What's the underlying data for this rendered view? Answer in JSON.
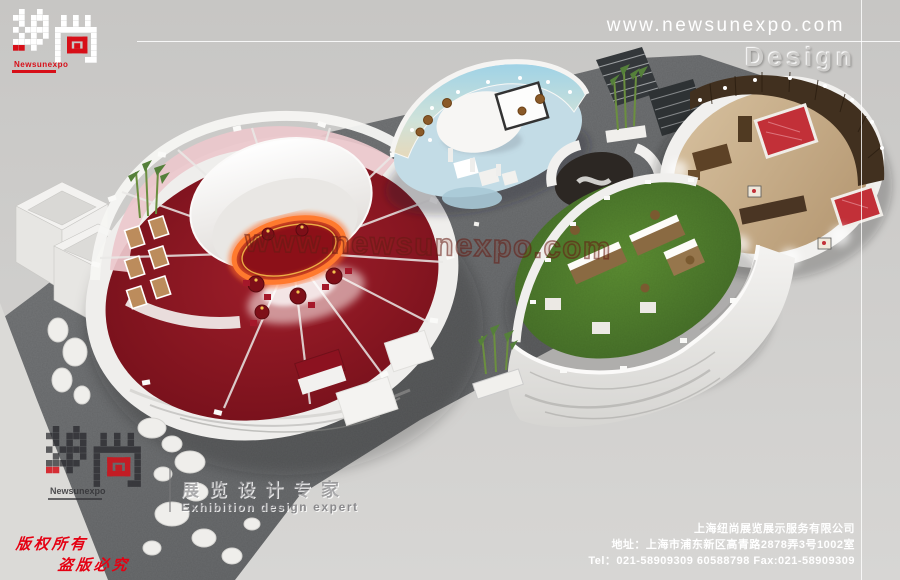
{
  "header": {
    "website": "www.newsunexpo.com",
    "design_label": "Design",
    "brand": "Newsunexpo"
  },
  "watermark": {
    "text": "www.newsunexpo.com"
  },
  "footer_logo": {
    "brand": "Newsunexpo",
    "tagline_cn": "展览设计专家",
    "tagline_en": "Exhibition design expert"
  },
  "copyright": {
    "line1": "版权所有",
    "line2": "盗版必究"
  },
  "company": {
    "name": "上海纽尚展览展示服务有限公司",
    "address": "地址：上海市浦东新区高青路2878弄3号1002室",
    "contacts": "Tel：021-58909309 60588798  Fax:021-58909309"
  },
  "colors": {
    "accent_red": "#d70f18",
    "copyright_red": "#e50012",
    "carpet_gray": "#6b6d6f",
    "booth_floor_red": "#8e1722",
    "grass_green": "#4f7d2a",
    "beach_sky_blue": "#9fd2e6",
    "wood_brown": "#41301f"
  }
}
